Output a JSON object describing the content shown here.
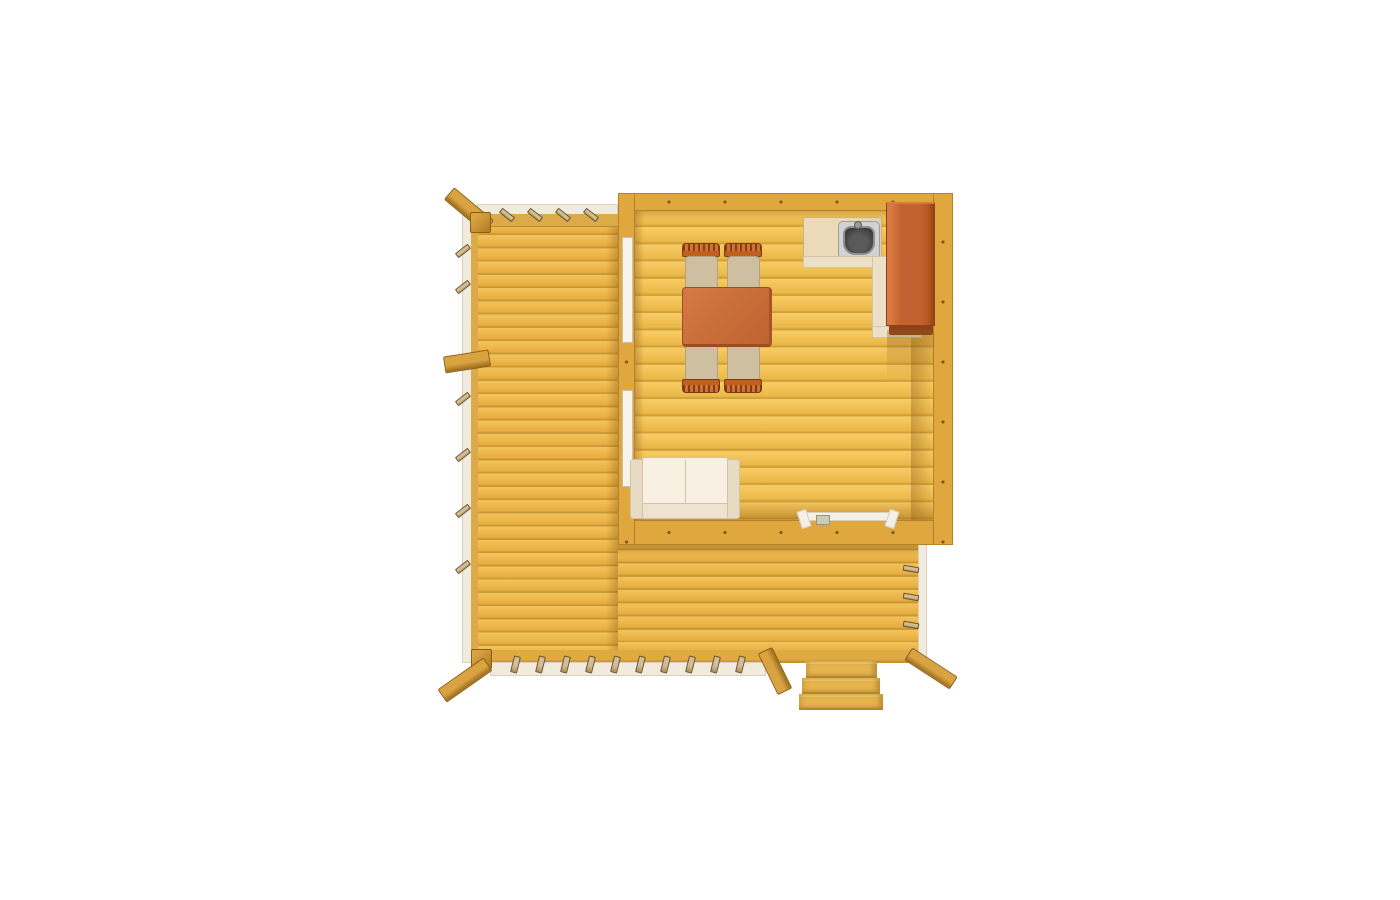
{
  "canvas": {
    "width": 1400,
    "height": 900,
    "background": "#ffffff"
  },
  "scene": {
    "type": "floor-plan-top-view",
    "subject": "wooden cabin with wrap-around terrace deck",
    "room": {
      "furniture": [
        "dining-table",
        "chair",
        "chair",
        "chair",
        "chair",
        "kitchen-counter",
        "sink",
        "tall-cabinet",
        "sofa"
      ],
      "openings": [
        "window-upper-left-wall",
        "window-lower-left-wall",
        "door-bottom-wall"
      ]
    },
    "terrace": {
      "railings": [
        "top",
        "left",
        "bottom",
        "right"
      ],
      "stairs": {
        "treads": 3
      },
      "corner_posts": 2,
      "handrail_beams": 4
    }
  },
  "palette": {
    "background": "#ffffff",
    "deck_plank": "#eeb94e",
    "floor_plank": "#f3c55c",
    "wall": "#dfa73d",
    "wall_edge": "#b5812a",
    "rail_cream": "#f1ebdd",
    "rail_mustard": "#dcaa48",
    "tab": "#d3bd92",
    "tab_dark": "#6b5536",
    "beam": "#d9a342",
    "beam_dark": "#9b6d1c",
    "fascia": "#e0aa43",
    "step": "#e5b44e",
    "step_light": "#f2ca68",
    "step_edge": "#b3872c",
    "table": "#c96f3a",
    "table_edge": "#9e4d22",
    "chair_seat": "#cdbf9f",
    "chair_rail": "#c0601f",
    "chair_rail_dark": "#8a3c10",
    "counter": "#e4d0ad",
    "cream": "#ece0c9",
    "cream_edge": "#d5c5a6",
    "cabinet": "#c26230",
    "cabinet_dark": "#8f421a",
    "cabinet_light": "#d97a42",
    "sink_rim": "#d2d2d2",
    "sink_bowl": "#2e2e2e",
    "sofa_back": "#f7f0e3",
    "sofa_arm": "#e7dbc4",
    "sofa_seat": "#eee3cf",
    "sofa_edge": "#d2c3a5",
    "window": "#f7f4ec",
    "window_edge": "#c9c1ae",
    "door_trim": "#f4f0e6",
    "shadow": "rgba(140,90,20,0.38)"
  }
}
